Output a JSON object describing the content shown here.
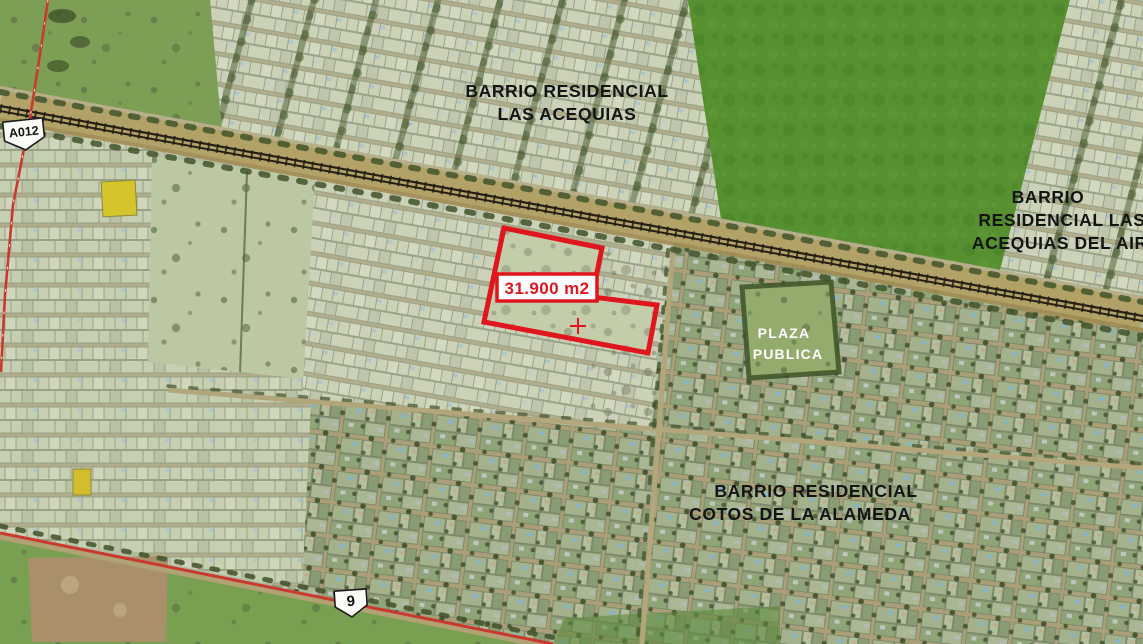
{
  "map": {
    "neighborhood_labels": {
      "las_acequias": {
        "line1": "BARRIO RESIDENCIAL",
        "line2": "LAS ACEQUIAS"
      },
      "las_acequias_del_aire": {
        "line1": "BARRIO",
        "line2": "RESIDENCIAL LAS",
        "line3": "ACEQUIAS DEL AIRE"
      },
      "cotos_de_la_alameda": {
        "line1": "BARRIO RESIDENCIAL",
        "line2": "COTOS DE LA ALAMEDA"
      },
      "plaza_publica": {
        "line1": "PLAZA",
        "line2": "PUBLICA"
      }
    },
    "parcel": {
      "area_label": "31.900 m2",
      "outline_color": "#e0161f"
    },
    "route_markers": {
      "a012": {
        "label": "A012"
      },
      "route9": {
        "label": "9"
      }
    },
    "colors": {
      "annotation_red": "#e0161f",
      "route_line_red": "#c9392d",
      "label_black": "#141414",
      "plaza_label_white": "#ffffff",
      "shield_fill": "#fbfbf7",
      "railway_dark": "#1d1912"
    }
  }
}
